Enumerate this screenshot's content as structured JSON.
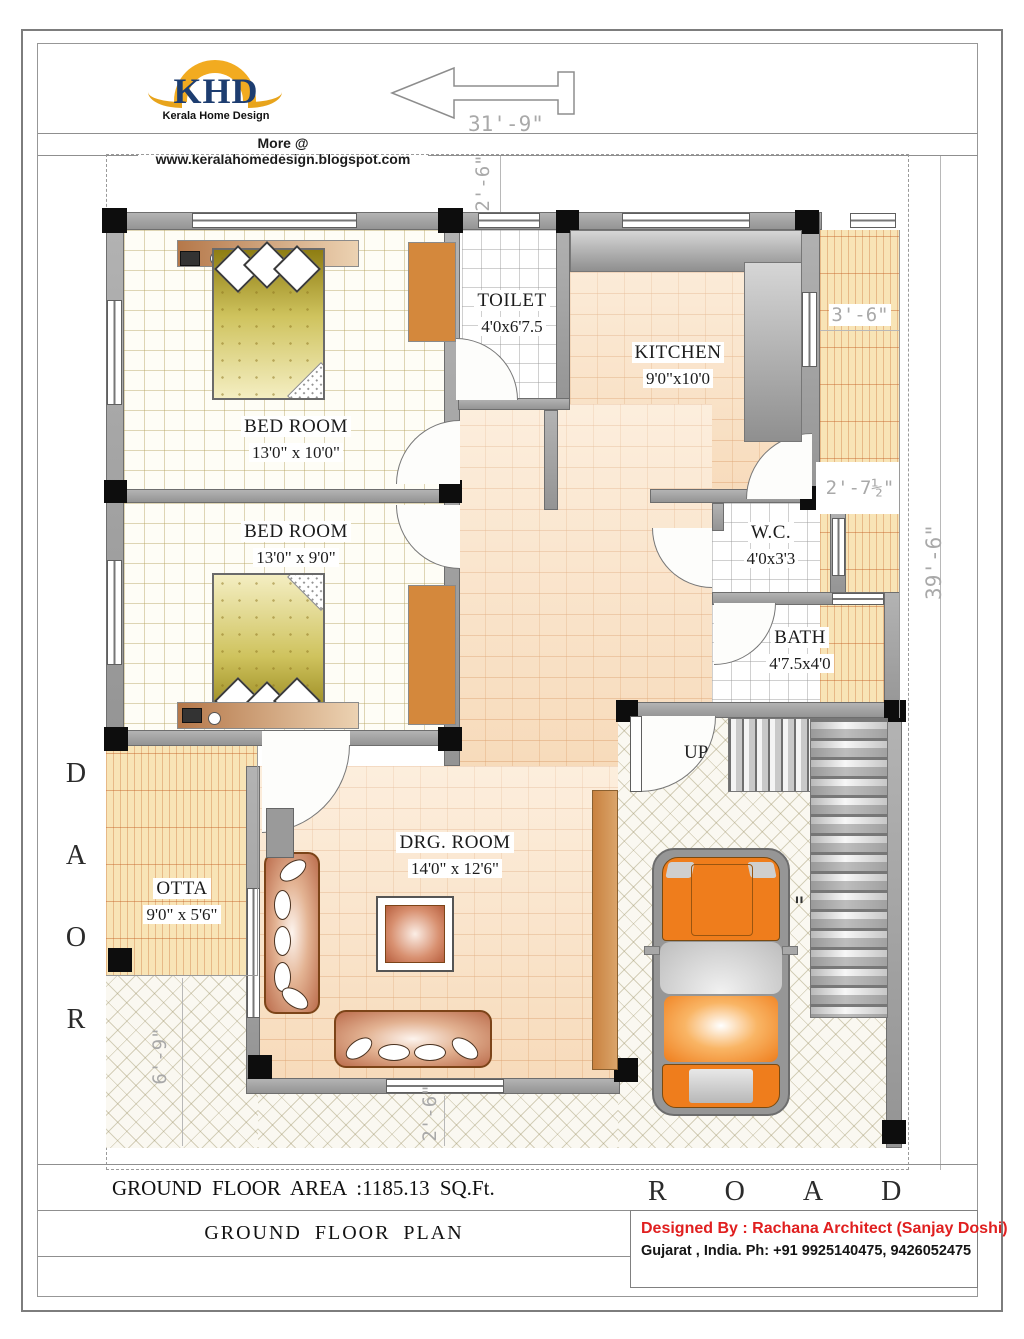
{
  "header": {
    "logo_text": "KHD",
    "logo_sub": "Kerala Home Design",
    "site": "More @ www.keralahomedesign.blogspot.com"
  },
  "rooms": {
    "bedroom1": {
      "name": "BED ROOM",
      "size": "13'0\" x 10'0\""
    },
    "bedroom2": {
      "name": "BED ROOM",
      "size": "13'0\" x 9'0\""
    },
    "toilet": {
      "name": "TOILET",
      "size": "4'0x6'7.5"
    },
    "kitchen": {
      "name": "KITCHEN",
      "size": "9'0\"x10'0"
    },
    "wc": {
      "name": "W.C.",
      "size": "4'0x3'3"
    },
    "bath": {
      "name": "BATH",
      "size": "4'7.5x4'0"
    },
    "drg": {
      "name": "DRG. ROOM",
      "size": "14'0\" x 12'6\""
    },
    "otta": {
      "name": "OTTA",
      "size": "9'0\" x 5'6\""
    },
    "stairs_label": "UP"
  },
  "dimensions": {
    "top_width": "31'-9\"",
    "top_setback": "2'-6\"",
    "right_strip": "3'-6\"",
    "right_offset": "2'-7½\"",
    "right_height": "39'-6\"",
    "left_front": "6'-9\"",
    "bottom_setback": "2'-6\"",
    "stray_quote": "\""
  },
  "road": {
    "left_letters": [
      "R",
      "O",
      "A",
      "D"
    ],
    "bottom": "ROAD"
  },
  "footer": {
    "area": "GROUND  FLOOR  AREA :1185.13 SQ.Ft.",
    "plan_title": "GROUND  FLOOR  PLAN",
    "credit1": "Designed By : Rachana Architect (Sanjay  Doshi)",
    "credit2": "Gujarat , India.  Ph: +91 9925140475, 9426052475",
    "credit1_color": "#e01f1f"
  }
}
